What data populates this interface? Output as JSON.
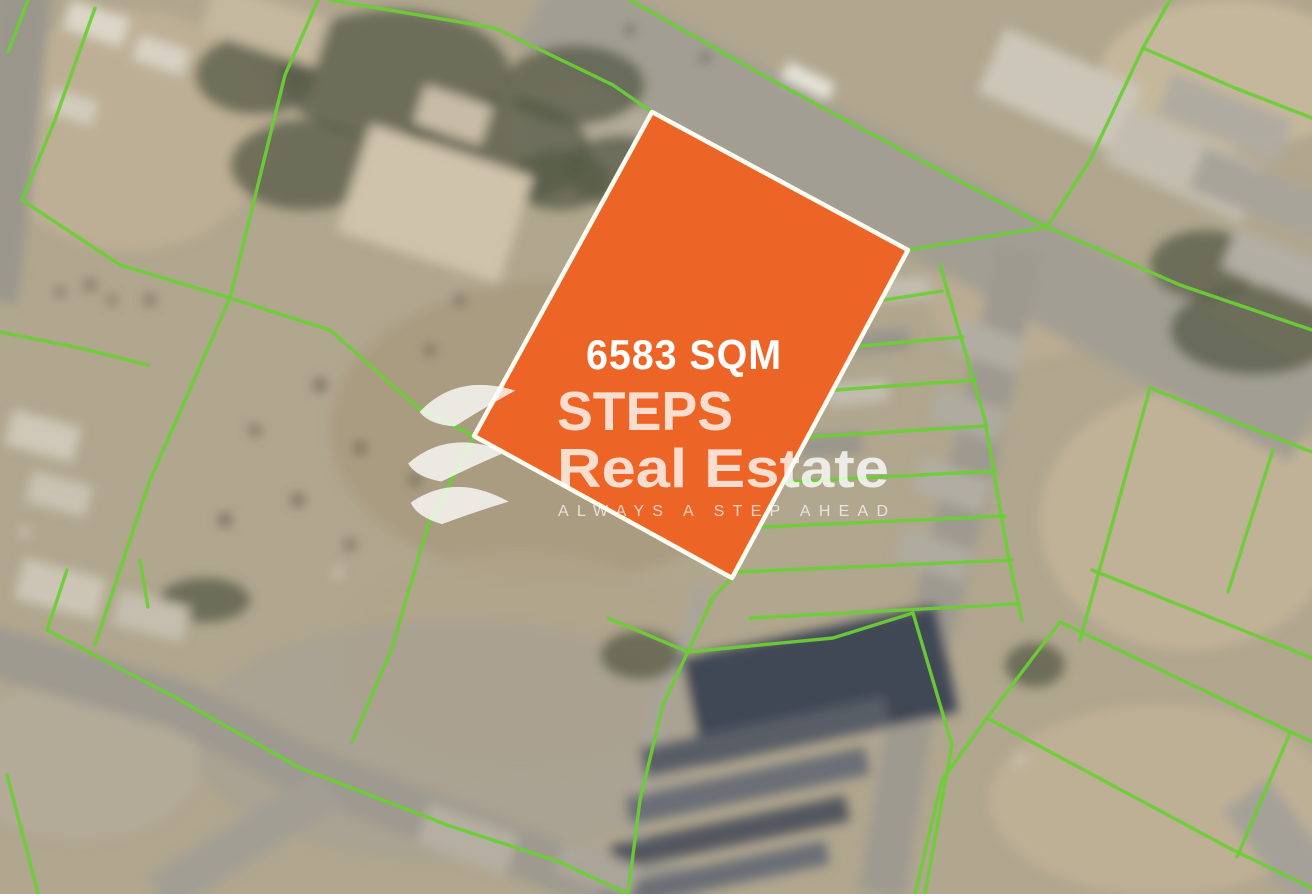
{
  "parcel": {
    "area_label": "6583 SQM",
    "points": "652,112 908,250 732,578 474,436",
    "fill_color": "#ED6526",
    "border_color": "#FFFDF2",
    "border_width": 4.5
  },
  "brand": {
    "name_line1": "STEPS",
    "name_line2": "Real Estate",
    "tagline": "ALWAYS A STEP AHEAD",
    "logo_icon": "steps-triple-swoosh-icon",
    "watermark_color": "#FFFFFF",
    "watermark_opacity": 0.78
  },
  "overlay": {
    "boundary_color": "#6CCE36",
    "boundary_width": 3.4,
    "boundary_lines": [
      "28,0 8,52",
      "95,8 55,120 22,200",
      "22,200 120,265 230,298",
      "318,0 285,75 230,298",
      "230,298 330,330 418,408 474,436",
      "230,298 150,480 95,645",
      "0,332 80,348 148,365",
      "140,560 148,607",
      "330,0 495,28 613,85 652,112",
      "630,0 777,83 920,160 1047,227",
      "908,250 980,238 1047,227",
      "1047,227 1090,160 1143,48 1170,0",
      "1143,48 1235,88 1312,118",
      "1047,227 1180,285 1312,330",
      "940,265 985,420 1008,555 1022,620",
      "884,300 942,291",
      "860,346 963,337",
      "836,390 975,380",
      "810,437 985,426",
      "786,482 996,471",
      "762,527 1005,516",
      "738,572 1012,560",
      "750,618 1018,604",
      "1150,388 1312,452",
      "1150,388 1080,640",
      "1273,450 1228,592",
      "1092,570 1312,658",
      "1060,622 1312,742",
      "987,718 1233,850 1312,888",
      "1290,733 1237,857",
      "1060,622 987,718 942,780 915,894",
      "712,600 663,705 640,800 628,894",
      "608,618 688,652",
      "688,652 833,638 913,613",
      "913,613 952,745 925,894",
      "732,578 710,600",
      "474,436 428,525 392,648 352,742",
      "67,570 47,630",
      "47,630 180,700 300,768 450,826 560,862 628,894",
      "7,775 38,893"
    ]
  },
  "scene": {
    "ground_color": "#b1a78f",
    "vegetation_color": "#565b47",
    "dot_color": "#6e6757",
    "sand_patches": [
      [
        1230,
        75,
        130,
        75,
        "#c8b99d",
        0.9
      ],
      [
        1190,
        520,
        150,
        130,
        "#c3b499",
        0.85
      ],
      [
        1160,
        800,
        170,
        95,
        "#c1b297",
        0.85
      ],
      [
        560,
        430,
        230,
        150,
        "#a89a7f",
        0.85
      ],
      [
        130,
        130,
        140,
        120,
        "#bfb196",
        0.8
      ],
      [
        520,
        660,
        180,
        110,
        "#b0a48a",
        0.7
      ],
      [
        1020,
        300,
        90,
        60,
        "#bdae93",
        0.8
      ],
      [
        600,
        130,
        90,
        40,
        "#b6ad9c",
        0.9
      ],
      [
        450,
        740,
        260,
        120,
        "#a7a093",
        0.7
      ],
      [
        80,
        760,
        120,
        80,
        "#b4ab9a",
        0.8
      ]
    ],
    "roads": [
      {
        "pts": "540,2 652,62 908,200 1312,420",
        "w": 95,
        "c": "#a29e93"
      },
      {
        "pts": "1020,250 975,455 912,705 882,894",
        "w": 46,
        "c": "#9e9a90"
      },
      {
        "pts": "-20,648 180,705 300,768 450,826 560,868 700,894",
        "w": 50,
        "c": "#9e9a90"
      },
      {
        "pts": "330,788 160,894",
        "w": 42,
        "c": "#a29e94"
      },
      {
        "pts": "25,-20 8,150 -10,300",
        "w": 55,
        "c": "#9a968c"
      },
      {
        "pts": "1245,795 1330,905",
        "w": 55,
        "c": "#a5a198"
      },
      {
        "pts": "705,585 660,710 638,820 630,894",
        "w": 16,
        "c": "#a8a49a"
      }
    ],
    "vegetation": [
      [
        395,
        75,
        115,
        65
      ],
      [
        495,
        150,
        95,
        55
      ],
      [
        305,
        165,
        75,
        45
      ],
      [
        575,
        85,
        70,
        40
      ],
      [
        620,
        170,
        55,
        35
      ],
      [
        255,
        75,
        60,
        40
      ],
      [
        1255,
        330,
        85,
        45
      ],
      [
        1205,
        265,
        55,
        35
      ],
      [
        1035,
        665,
        30,
        22
      ],
      [
        205,
        600,
        45,
        22
      ],
      [
        640,
        655,
        40,
        25
      ],
      [
        560,
        180,
        50,
        30
      ]
    ],
    "buildings": [
      [
        65,
        8,
        62,
        30,
        18,
        "#dcd6c8"
      ],
      [
        135,
        42,
        52,
        26,
        18,
        "#d8d2c4"
      ],
      [
        50,
        95,
        46,
        24,
        18,
        "#d2ccbe"
      ],
      [
        205,
        0,
        120,
        50,
        18,
        "#c4b89f"
      ],
      [
        350,
        148,
        170,
        112,
        18,
        "#cfc3ab"
      ],
      [
        418,
        95,
        70,
        40,
        18,
        "#c8bca6"
      ],
      [
        985,
        55,
        150,
        70,
        24,
        "#ccc6b8"
      ],
      [
        1110,
        135,
        150,
        60,
        24,
        "#c3bdaf"
      ],
      [
        782,
        72,
        52,
        18,
        26,
        "#e6e3da"
      ],
      [
        1160,
        95,
        130,
        45,
        22,
        "#b0aba0"
      ],
      [
        1192,
        170,
        132,
        45,
        22,
        "#a8a49a"
      ],
      [
        1225,
        250,
        122,
        42,
        22,
        "#b3aea4"
      ],
      [
        952,
        328,
        72,
        34,
        20,
        "#b2ada2"
      ],
      [
        932,
        398,
        72,
        34,
        20,
        "#aeaa9f"
      ],
      [
        915,
        468,
        72,
        34,
        20,
        "#b2ada2"
      ],
      [
        898,
        538,
        72,
        34,
        20,
        "#aeaa9f"
      ],
      [
        872,
        278,
        58,
        22,
        -5,
        "#c3bdb0"
      ],
      [
        850,
        330,
        60,
        22,
        -5,
        "#9a958b"
      ],
      [
        828,
        382,
        60,
        22,
        -5,
        "#c3bdb0"
      ],
      [
        800,
        434,
        62,
        22,
        -5,
        "#9a958b"
      ],
      [
        690,
        630,
        260,
        110,
        -12,
        "#414654"
      ],
      [
        640,
        722,
        250,
        30,
        -12,
        "#595d66"
      ],
      [
        625,
        772,
        245,
        28,
        -12,
        "#6a6e76"
      ],
      [
        610,
        820,
        240,
        26,
        -12,
        "#53575f"
      ],
      [
        600,
        864,
        230,
        24,
        -12,
        "#6a6e76"
      ],
      [
        18,
        568,
        85,
        42,
        15,
        "#ccc5b5"
      ],
      [
        115,
        598,
        72,
        36,
        15,
        "#c5beae"
      ],
      [
        420,
        818,
        95,
        42,
        20,
        "#b5afa1"
      ],
      [
        556,
        852,
        82,
        36,
        20,
        "#aba599"
      ],
      [
        8,
        418,
        70,
        36,
        15,
        "#cfc8b8"
      ],
      [
        28,
        478,
        62,
        32,
        15,
        "#c9c2b2"
      ]
    ],
    "ground_dots": [
      [
        320,
        385,
        7
      ],
      [
        360,
        448,
        7
      ],
      [
        298,
        500,
        7
      ],
      [
        415,
        480,
        7
      ],
      [
        255,
        430,
        6
      ],
      [
        225,
        520,
        7
      ],
      [
        350,
        545,
        6
      ],
      [
        150,
        300,
        6
      ],
      [
        90,
        285,
        6
      ],
      [
        430,
        350,
        6
      ],
      [
        460,
        300,
        6
      ],
      [
        60,
        292,
        5
      ],
      [
        112,
        300,
        5
      ],
      [
        630,
        30,
        5,
        "#55514a"
      ],
      [
        705,
        58,
        5,
        "#55514a"
      ],
      [
        25,
        532,
        4,
        "#e5e1d7"
      ],
      [
        338,
        573,
        4,
        "#e8e4da"
      ],
      [
        1020,
        760,
        4,
        "#dedace"
      ]
    ]
  }
}
